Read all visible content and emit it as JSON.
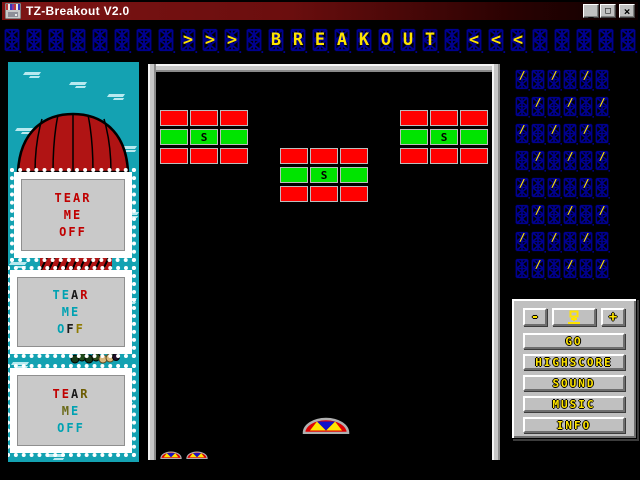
{
  "window": {
    "title": "TZ-Breakout V2.0",
    "controls": {
      "minimize": "_",
      "maximize": "□",
      "close": "×"
    }
  },
  "marquee": {
    "title": "BREAKOUT",
    "left_decor": ">>>",
    "right_decor": "<<<",
    "pattern": "        >>> BREAKOUT <<<     ",
    "dim_color": "#000090",
    "lit_color": "#ffe400"
  },
  "sidebar": {
    "stamps": [
      {
        "lines": [
          {
            "text": "TEAR",
            "colors": [
              "#c00000",
              "#c00000",
              "#c00000",
              "#c00000"
            ]
          },
          {
            "text": "ME",
            "colors": [
              "#c00000",
              "#c00000"
            ]
          },
          {
            "text": "OFF",
            "colors": [
              "#c00000",
              "#c00000",
              "#c00000"
            ]
          }
        ]
      },
      {
        "lines": [
          {
            "text": "TEAR",
            "colors": [
              "#00a2b2",
              "#00a2b2",
              "#1a1a1a",
              "#c00000"
            ]
          },
          {
            "text": "ME",
            "colors": [
              "#00a2b2",
              "#00a2b2"
            ]
          },
          {
            "text": "OFF",
            "colors": [
              "#00a2b2",
              "#1a1a1a",
              "#8f7a00"
            ]
          }
        ]
      },
      {
        "lines": [
          {
            "text": "TEAR",
            "colors": [
              "#c00000",
              "#c00000",
              "#1a1a1a",
              "#6b5b00"
            ]
          },
          {
            "text": "ME",
            "colors": [
              "#6b6b1a",
              "#00a2b2"
            ]
          },
          {
            "text": "OFF",
            "colors": [
              "#00a2b2",
              "#00a2b2",
              "#00a2b2"
            ]
          }
        ]
      }
    ]
  },
  "playfield": {
    "special_letter": "S",
    "lives": 2,
    "brick_colors": {
      "R": "#ff0000",
      "G": "#00e400",
      "S": "#00e400"
    },
    "groups": [
      {
        "x": 4,
        "y": 38,
        "rows": [
          [
            "R",
            "R",
            "R"
          ],
          [
            "G",
            "S",
            "G"
          ],
          [
            "R",
            "R",
            "R"
          ]
        ]
      },
      {
        "x": 124,
        "y": 76,
        "rows": [
          [
            "R",
            "R",
            "R"
          ],
          [
            "G",
            "S",
            "G"
          ],
          [
            "R",
            "R",
            "R"
          ]
        ]
      },
      {
        "x": 244,
        "y": 38,
        "rows": [
          [
            "R",
            "R",
            "R"
          ],
          [
            "G",
            "S",
            "G"
          ],
          [
            "R",
            "R",
            "R"
          ]
        ]
      }
    ]
  },
  "led_grid": {
    "cols": 6,
    "rows": 8,
    "mark": "/"
  },
  "control_panel": {
    "minus": "-",
    "plus": "+",
    "buttons": [
      "GO",
      "HIGHSCORE",
      "SOUND",
      "MUSIC",
      "INFO"
    ]
  },
  "colors": {
    "titlebar_left": "#7c1414",
    "titlebar_right": "#0d0000",
    "sidebar_teal": "#14a2b2",
    "led_dim": "#000090",
    "led_lit": "#ffe400",
    "panel_gray": "#c0c0c0"
  }
}
